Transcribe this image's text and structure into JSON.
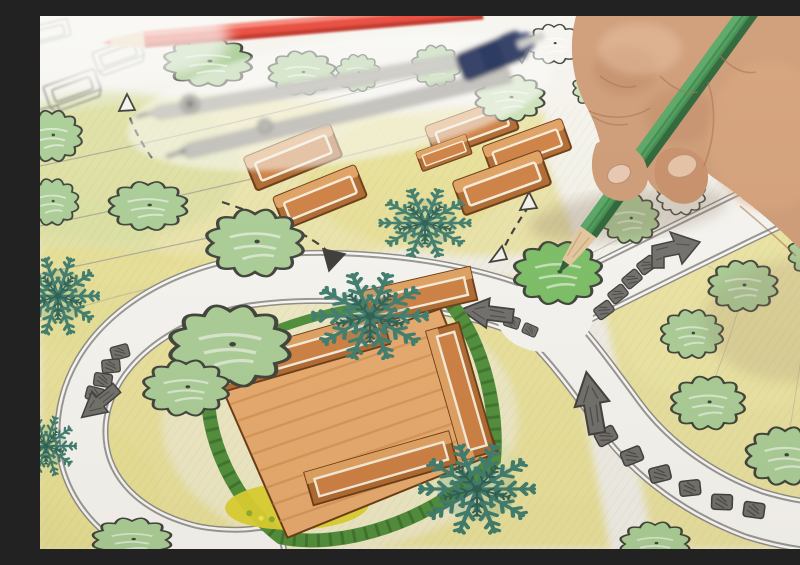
{
  "meta": {
    "description": "Close-up photograph of a designer's hand holding a green colored pencil, coloring a round tree symbol on a hand-drawn landscape architecture garden plan; a red colored pencil and a metal drafting compass with dark blue handle lie on the paper"
  },
  "scene": {
    "hand": {
      "label": "right hand gripping pencil",
      "skin_tone": "tan"
    },
    "tools": [
      {
        "name": "green colored pencil",
        "state": "coloring a tree symbol"
      },
      {
        "name": "red colored pencil",
        "state": "lying across top of sheet"
      },
      {
        "name": "drafting compass",
        "detail": "silver metal, dark navy handle, out of focus"
      }
    ],
    "plan": {
      "ground": "yellow-green pencil shading with thin grey survey lines",
      "paths": [
        "curved ring walkway around central pavilion",
        "branch walkway to upper right"
      ],
      "trees_colored": 20,
      "trees_outline_only": 4,
      "conifer_symbols": 5,
      "orange_structure_clusters": 2,
      "central_pavilion": "orange axonometric courtyard building with hedge and yellow flower bed",
      "stepping_stone_groups": 4,
      "grey_direction_arrows": 4,
      "dashed_guide_arrows": 4,
      "extras": [
        "outline bench sketches in top-left corner"
      ]
    }
  },
  "colors": {
    "c-paper": "#f3f1ea",
    "c-paperBright": "#f7f5ef",
    "c-groundYellow": "#eae294",
    "c-groundYellowLight": "#f0e9a8",
    "c-groundGreen": "#d7e0a0",
    "c-insideRing": "#f1edcf",
    "c-tree": "#abcf97",
    "c-treeLight": "#cce3b8",
    "c-treeBright": "#7cc066",
    "c-treeOutline": "#3e423a",
    "c-conifer": "#3e7d6e",
    "c-coniferDark": "#2c5f54",
    "c-orange": "#cf8142",
    "c-orangeLight": "#e2a262",
    "c-orangeDeep": "#b06a30",
    "c-orangeDark": "#6b3a14",
    "c-deck": "#e8ab6d",
    "c-cream": "#f7efdd",
    "c-hedge": "#4f8f3a",
    "c-hedgeDark": "#3a6e2c",
    "c-flower": "#ded32f",
    "c-flowerGreen": "#8fae2e",
    "c-stone": "#706f6b",
    "c-stoneDark": "#3f3e3b",
    "c-lineGrey": "#a3a29a",
    "c-pathEdge": "#8e8d87",
    "c-pencilGreen": "#3d8a4b",
    "c-pencilGreenLight": "#57a765",
    "c-pencilGreenDark": "#2c6437",
    "c-wood": "#e6c89e",
    "c-leadGreen": "#2d5b35",
    "c-redPencil": "#e8483a",
    "c-redPencilLight": "#f58577",
    "c-redPencilDark": "#c03227",
    "c-compassSilver": "#cfcec9",
    "c-compassNavy": "#2d3a64",
    "c-skin": "#cf9c77",
    "c-skinDark": "#a3704e",
    "c-skinLight": "#edc9a8",
    "c-nail": "#e9c9b2"
  }
}
